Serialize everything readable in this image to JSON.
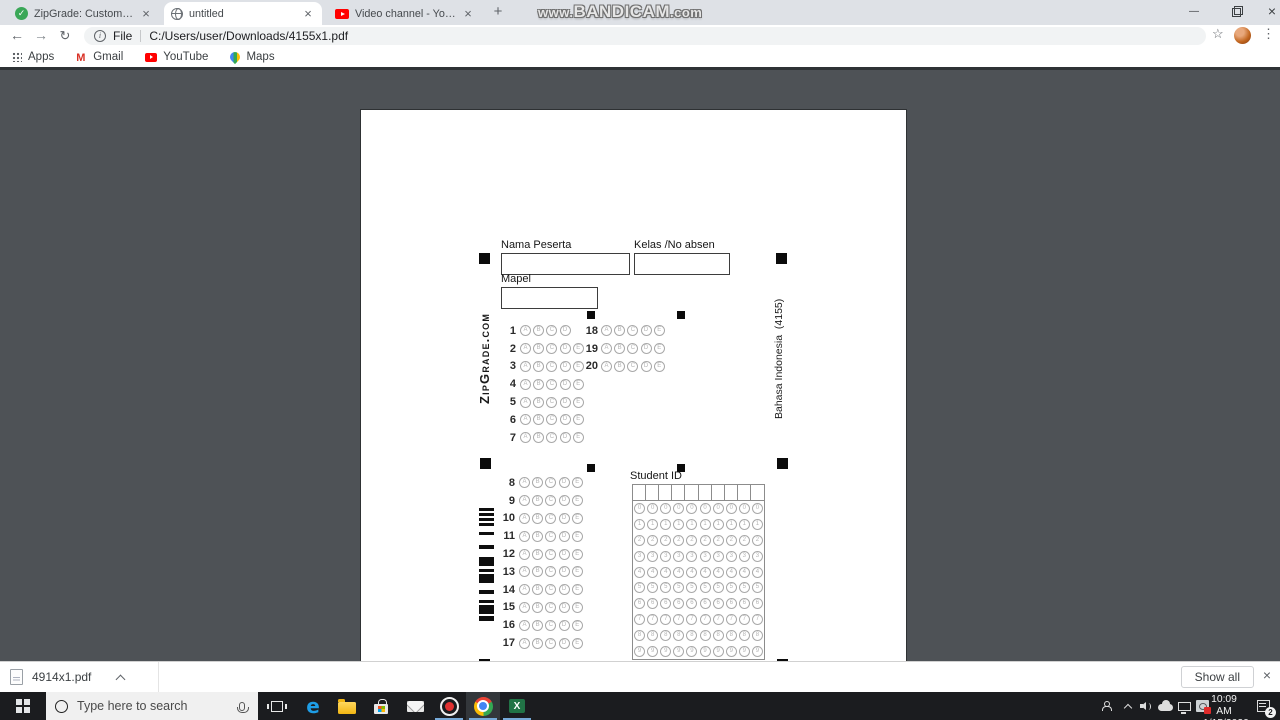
{
  "watermark": {
    "prefix": "www.",
    "main": "BANDICAM",
    "suffix": ".com"
  },
  "browser": {
    "tabs": [
      {
        "title": "ZipGrade: Custom Answer Sheets",
        "favicon": "zipgrade-check-icon",
        "active": false
      },
      {
        "title": "untitled",
        "favicon": "globe-icon",
        "active": true
      },
      {
        "title": "Video channel - YouTube Studio",
        "favicon": "youtube-icon",
        "active": false
      }
    ],
    "address": {
      "scheme_label": "File",
      "url_path": "C:/Users/user/Downloads/4155x1.pdf"
    },
    "bookmarks": [
      {
        "label": "Apps",
        "icon": "apps-grid-icon"
      },
      {
        "label": "Gmail",
        "icon": "gmail-icon"
      },
      {
        "label": "YouTube",
        "icon": "youtube-icon"
      },
      {
        "label": "Maps",
        "icon": "maps-pin-icon"
      }
    ]
  },
  "pdf_sheet": {
    "fields": {
      "name_label": "Nama Peserta",
      "class_label": "Kelas /No absen",
      "subject_label": "Mapel",
      "student_id_label": "Student ID"
    },
    "branding_left": "ZipGrade.com",
    "branding_right": "Bahasa Indonesia  (4155)",
    "choices": [
      "A",
      "B",
      "C",
      "D",
      "E"
    ],
    "answer_groups": [
      {
        "name": "q1_7",
        "rows": [
          {
            "n": "1",
            "c": [
              "A",
              "B",
              "C",
              "D"
            ]
          },
          {
            "n": "2"
          },
          {
            "n": "3"
          },
          {
            "n": "4"
          },
          {
            "n": "5"
          },
          {
            "n": "6"
          },
          {
            "n": "7"
          }
        ]
      },
      {
        "name": "q18_20",
        "rows": [
          {
            "n": "18"
          },
          {
            "n": "19"
          },
          {
            "n": "20"
          }
        ]
      },
      {
        "name": "q8_17",
        "rows": [
          {
            "n": "8"
          },
          {
            "n": "9"
          },
          {
            "n": "10"
          },
          {
            "n": "11"
          },
          {
            "n": "12"
          },
          {
            "n": "13"
          },
          {
            "n": "14"
          },
          {
            "n": "15"
          },
          {
            "n": "16"
          },
          {
            "n": "17"
          }
        ]
      }
    ],
    "id_digits": [
      "0",
      "1",
      "2",
      "3",
      "4",
      "5",
      "6",
      "7",
      "8",
      "9"
    ],
    "id_columns": 10,
    "barcode_pattern": [
      [
        0,
        3
      ],
      [
        5,
        3
      ],
      [
        10,
        3
      ],
      [
        15,
        3
      ],
      [
        24,
        3
      ],
      [
        37,
        4
      ],
      [
        49,
        9
      ],
      [
        61,
        3
      ],
      [
        66,
        9
      ],
      [
        82,
        4
      ],
      [
        92,
        3
      ],
      [
        97,
        9
      ],
      [
        108,
        5
      ]
    ]
  },
  "download_bar": {
    "filename": "4914x1.pdf",
    "show_all_label": "Show all"
  },
  "taskbar": {
    "search_placeholder": "Type here to search",
    "time": "10:09 AM",
    "date": "1/15/2020",
    "notification_count": "2"
  },
  "colors": {
    "zipgrade_green": "#3aa757",
    "youtube_red": "#ff0000",
    "bandicam_red": "#e03131",
    "taskbar_underline": "#76a9d8",
    "pdf_background": "#4e5256"
  }
}
